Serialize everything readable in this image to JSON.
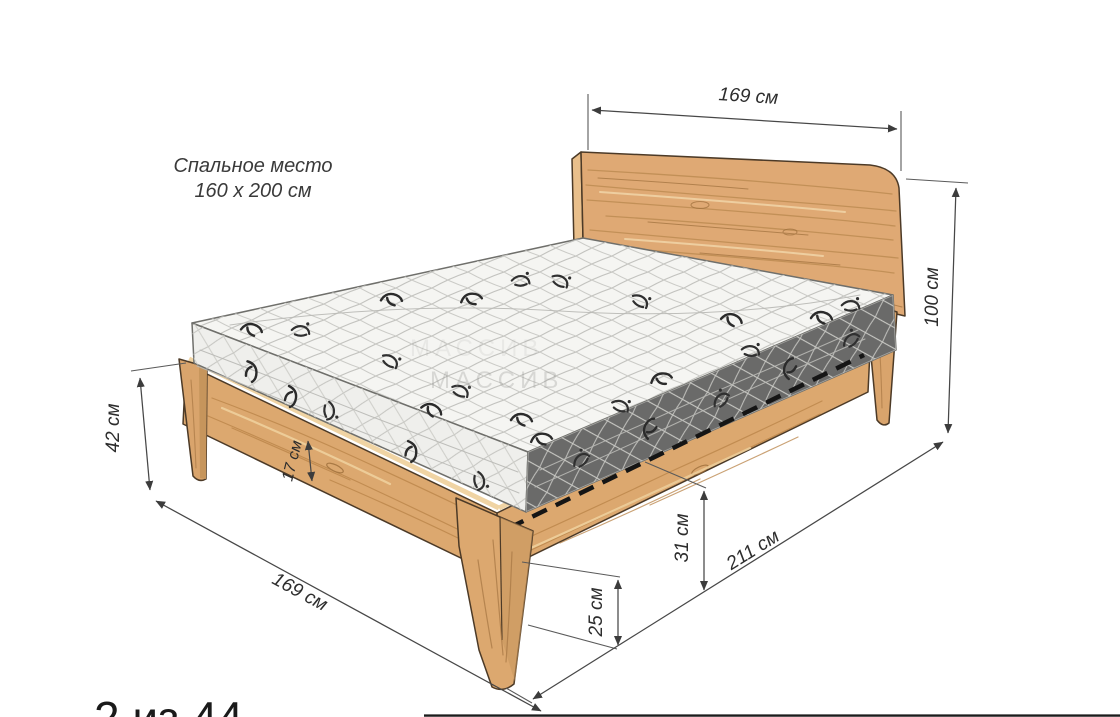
{
  "labels": {
    "sleeping_area_title": "Спальное место",
    "sleeping_area_size": "160 x 200 см",
    "watermark": "МАССИВ",
    "page_indicator": "2 из 44"
  },
  "dimensions": {
    "headboard_width": "169 см",
    "total_height": "100 см",
    "frame_side_height": "42 см",
    "rail_board_height": "17 см",
    "slat_level_height": "31 см",
    "under_bed_clearance": "25 см",
    "floor_width": "169 см",
    "floor_length": "211 см"
  },
  "colors": {
    "background": "#ffffff",
    "wood_base": "#dfa974",
    "wood_light": "#f0d4a4",
    "wood_grain_dark": "#9a6b38",
    "outline": "#4c3a27",
    "mattress": "#f4f4f1",
    "quilt_line": "#c3c3bf",
    "dashed_slat_line": "#151515",
    "dimension_line": "#474747",
    "text": "#2d2d2d"
  }
}
